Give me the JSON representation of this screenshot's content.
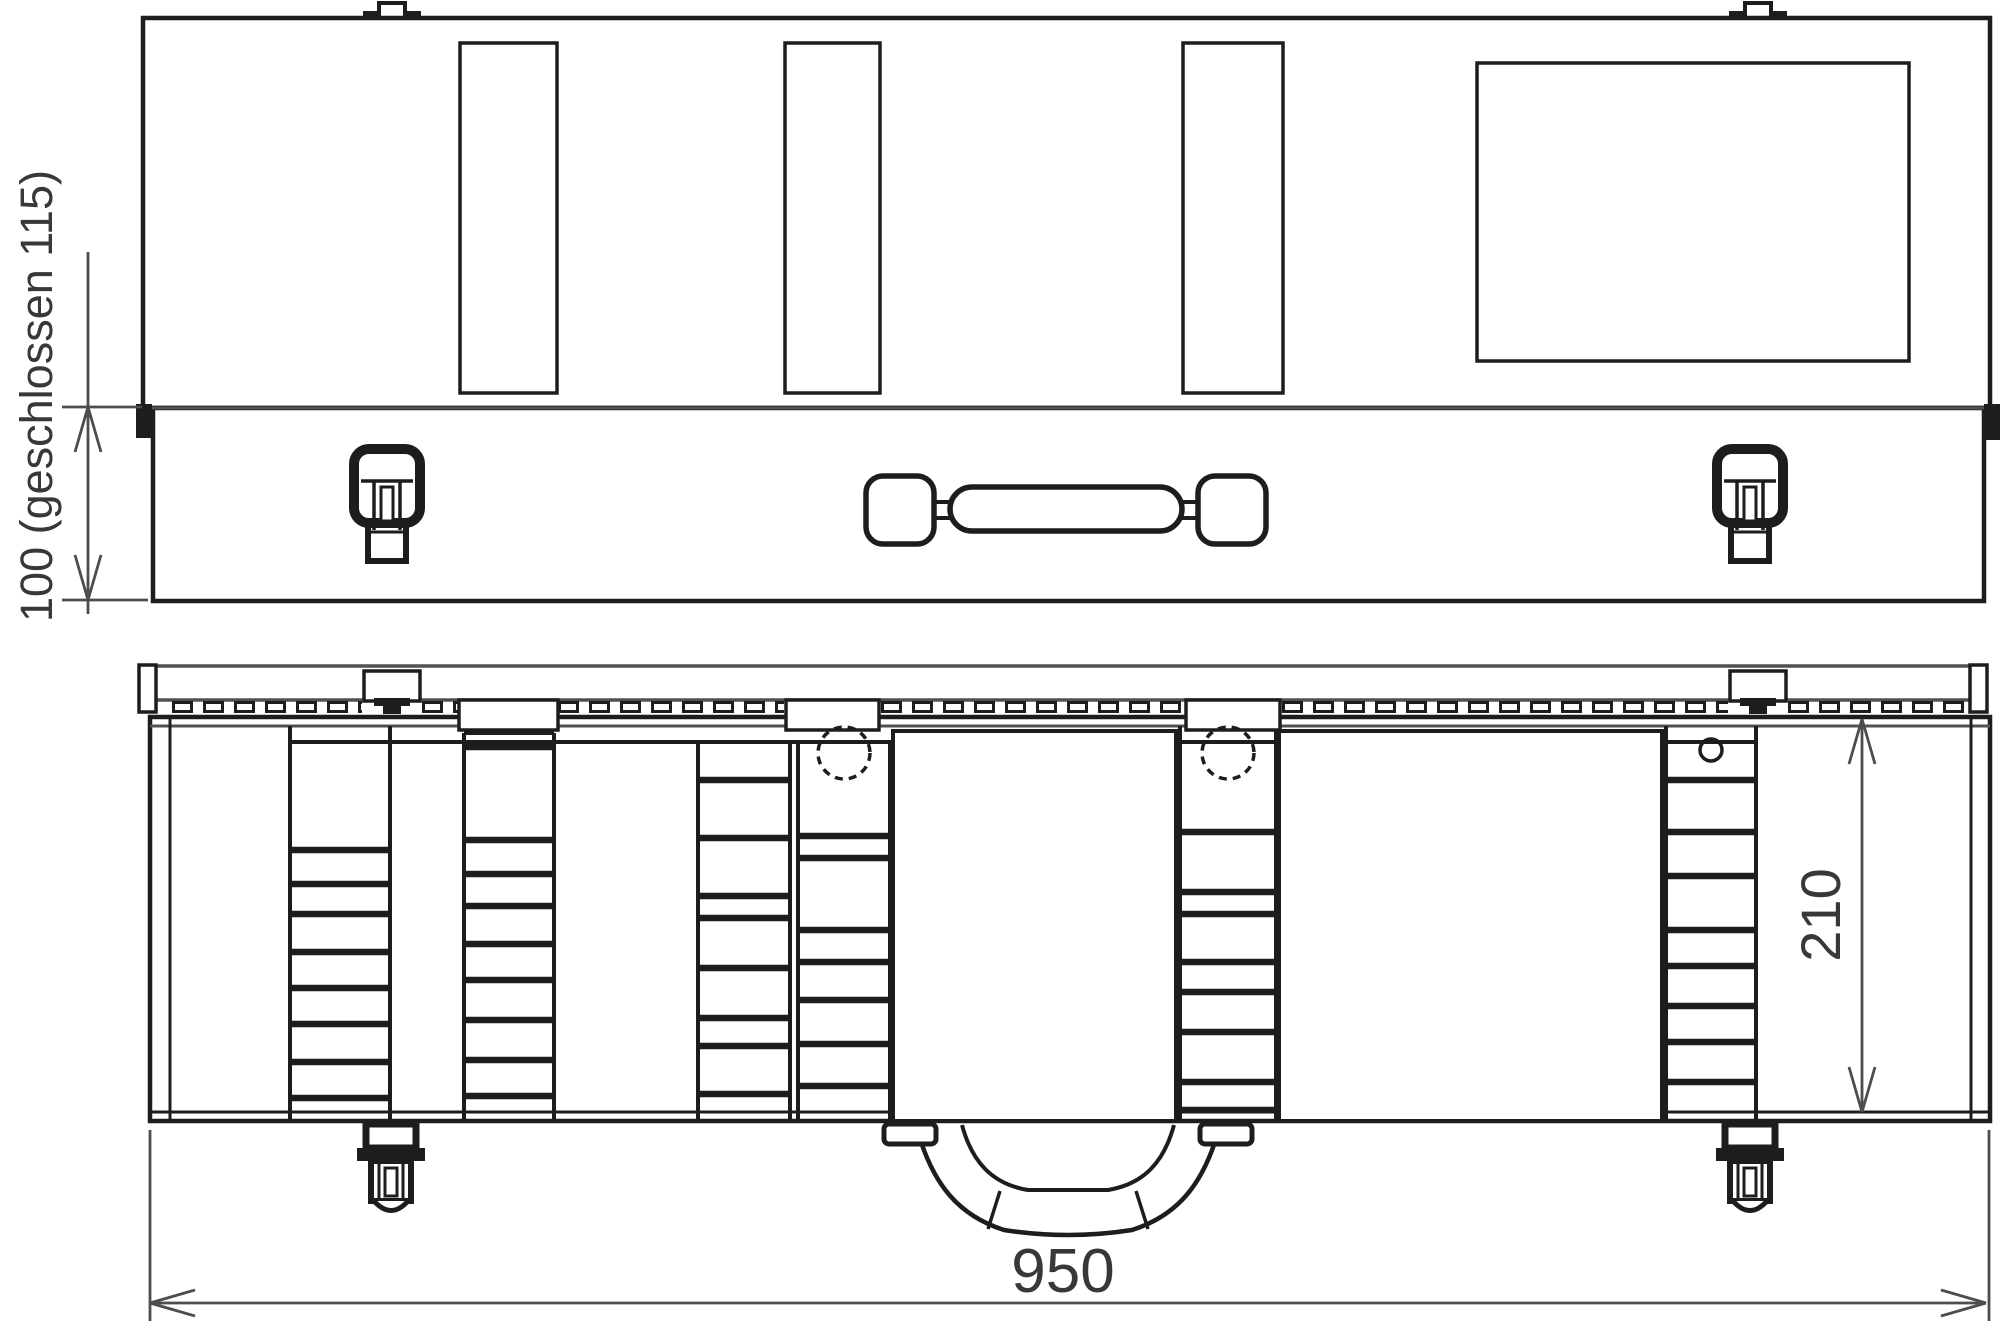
{
  "page": {
    "background": "#ffffff"
  },
  "drawing": {
    "type": "technical-drawing",
    "stroke_color": "#1d1d1d",
    "secondary_stroke_color": "#515151",
    "dimension_color": "#4d4d4d",
    "text_color": "#383838",
    "dimensions": {
      "height": "100 (geschlossen 115)",
      "depth": "210",
      "width": "950"
    }
  }
}
